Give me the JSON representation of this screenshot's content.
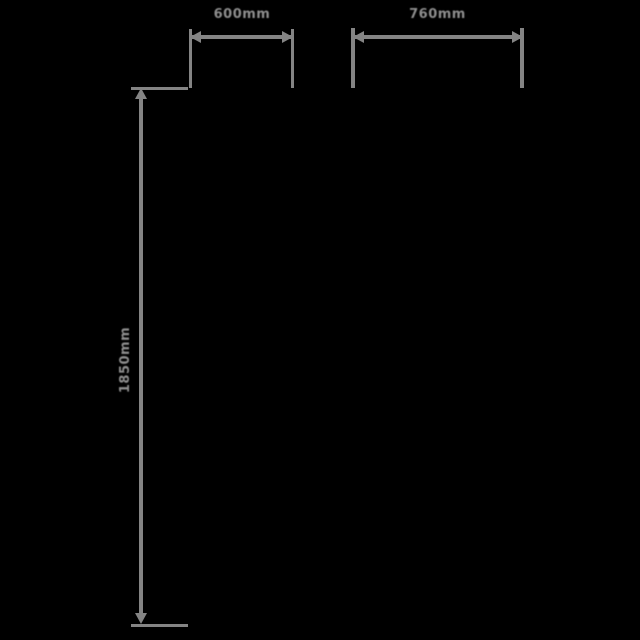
{
  "canvas": {
    "background_color": "#000000",
    "line_color": "#848484",
    "text_color": "#8d8d8d",
    "description": "Product dimension diagram overlay on black background"
  },
  "dimensions": {
    "top_left_width": {
      "label": "600mm"
    },
    "top_right_width": {
      "label": "760mm"
    },
    "left_height": {
      "label": "1850mm"
    }
  }
}
